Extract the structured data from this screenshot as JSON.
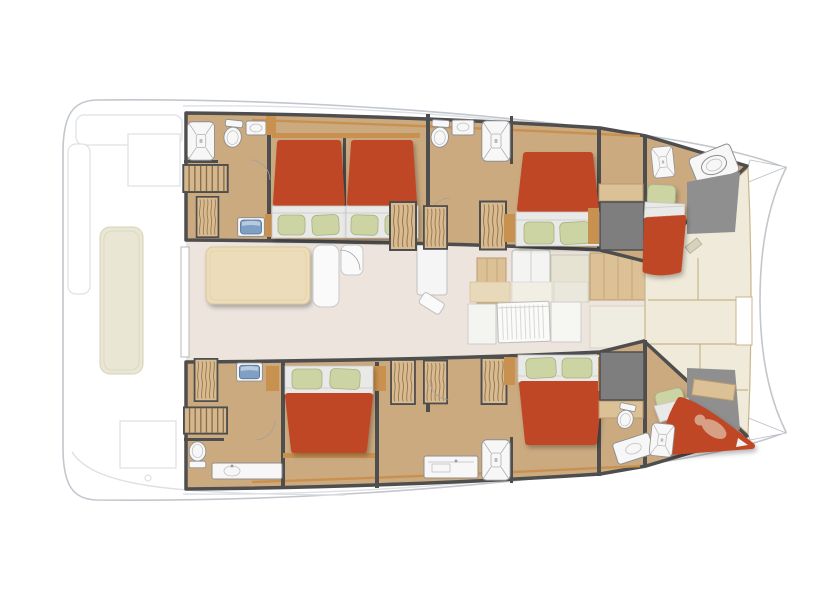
{
  "page": {
    "title": "Catamaran interior deck plan",
    "background": "#ffffff"
  },
  "diagram": {
    "type": "yacht-floor-plan",
    "vessel_type": "sailing catamaran",
    "view": "top-down interior layout",
    "orientation": "bow-right",
    "areas": [
      {
        "id": "aft-deck",
        "label": "Aft deck cockpit",
        "features": [
          "bench cushion",
          "transom platform",
          "deck hatches"
        ]
      },
      {
        "id": "saloon",
        "label": "Saloon and galley",
        "features": [
          "dining table",
          "sofa",
          "chart seat",
          "fridge",
          "galley units",
          "slatted companionway door"
        ]
      },
      {
        "id": "port-hull",
        "label": "Port hull (top)",
        "cabins": [
          {
            "id": "port-aft-cabin",
            "features": [
              "double bed",
              "shower",
              "toilet",
              "washbasin",
              "staircase",
              "wardrobe"
            ]
          },
          {
            "id": "port-mid-cabin",
            "features": [
              "double bed",
              "toilet",
              "washbasin",
              "shower",
              "wardrobes"
            ]
          },
          {
            "id": "port-forward-cabin",
            "features": [
              "double bed",
              "wardrobe"
            ]
          },
          {
            "id": "port-bow-cabin",
            "features": [
              "single berth",
              "shower",
              "toilet"
            ]
          }
        ]
      },
      {
        "id": "starboard-hull",
        "label": "Starboard hull (bottom)",
        "cabins": [
          {
            "id": "starboard-aft-cabin",
            "features": [
              "double bed",
              "staircase",
              "toilet",
              "counter with washbasin",
              "wardrobe"
            ]
          },
          {
            "id": "starboard-mid-bathroom",
            "features": [
              "shower",
              "vanity",
              "wardrobes"
            ]
          },
          {
            "id": "starboard-forward-cabin",
            "features": [
              "double bed",
              "wardrobe"
            ]
          },
          {
            "id": "starboard-bow-cabin",
            "features": [
              "single berth",
              "shower",
              "toilet",
              "washbasin",
              "resting figure"
            ]
          }
        ]
      },
      {
        "id": "foredeck",
        "label": "Foredeck",
        "features": [
          "deck panels",
          "windlass"
        ]
      }
    ],
    "fixture_counts": {
      "double_beds": 5,
      "single_berths": 2,
      "showers": 5,
      "toilets": 5,
      "staircases": 2,
      "wardrobes": 8
    },
    "colors": {
      "outline": "#c2c7cd",
      "deckline": "#dde0e4",
      "wall": "#4e4e4e",
      "floor_tan": "#cbaa80",
      "wood": "#c9914f",
      "wood_dark": "#8d6b43",
      "locker_wood": "#d8bb90",
      "stairs_wood": "#d3b88f",
      "bed_red": "#bf4628",
      "mattress": "#e9e9e8",
      "pillow": "#cdd4a3",
      "pillow_edge": "#a9b183",
      "saloon_floor": "#ece4dd",
      "table_wood": "#eddcb9",
      "foredeck": "#efead9",
      "foredeck_line": "#c9b48c",
      "gray_block": "#7e7e7e",
      "gray_wedge": "#8f8f8f",
      "cushion_beige": "#e9e6d3",
      "sink_blue": "#7fa0c4",
      "skin": "#d79f84",
      "white_fixture": "#f7f7f7",
      "fixture_stroke": "#8f8f8f",
      "galley_wood": "#dcc096"
    }
  }
}
